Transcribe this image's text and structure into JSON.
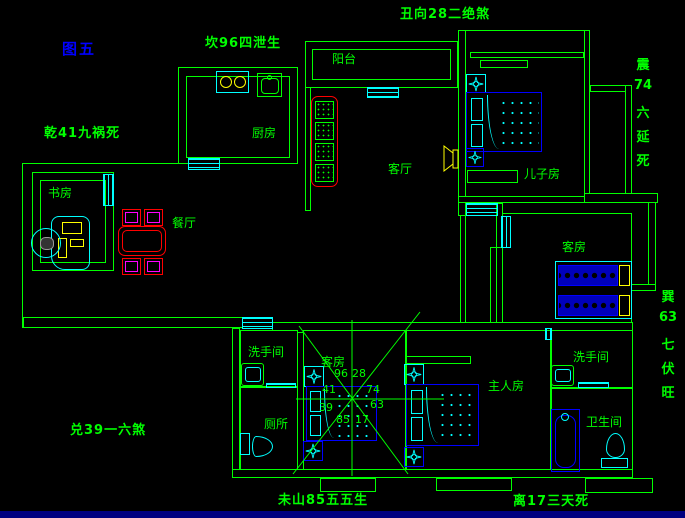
{
  "figure_label": "图五",
  "fengshui": {
    "kan": "坎96四泄生",
    "chou": "丑向28二绝煞",
    "qian": "乾41九祸死",
    "dui": "兑39一六煞",
    "wei": "未山85五五生",
    "li": "离17三天死",
    "zhen": {
      "chars": [
        "震",
        "74",
        "六",
        "延",
        "死"
      ]
    },
    "xun": {
      "chars": [
        "巽",
        "63",
        "七",
        "伏",
        "旺"
      ]
    }
  },
  "rooms": {
    "balcony": "阳台",
    "kitchen": "厨房",
    "living": "客厅",
    "sons_room": "儿子房",
    "guest_right": "客房",
    "study": "书房",
    "dining": "餐厅",
    "washroom_left": "洗手间",
    "toilet": "厕所",
    "guest_center": "客房",
    "master": "主人房",
    "washroom_right": "洗手间",
    "bathroom": "卫生间"
  },
  "compass": {
    "tl": "41",
    "t1": "96",
    "t2": "28",
    "tr": "74",
    "l": "39",
    "r": "63",
    "b1": "85",
    "b2": "17"
  },
  "colors": {
    "wall": "#00ff00",
    "window": "#00ffff",
    "furniture": "#0000ff",
    "sofa": "#ff0000",
    "accent": "#ffff00",
    "chair": "#ff00ff",
    "figure": "#0000ff",
    "statusbar": "#000080"
  }
}
